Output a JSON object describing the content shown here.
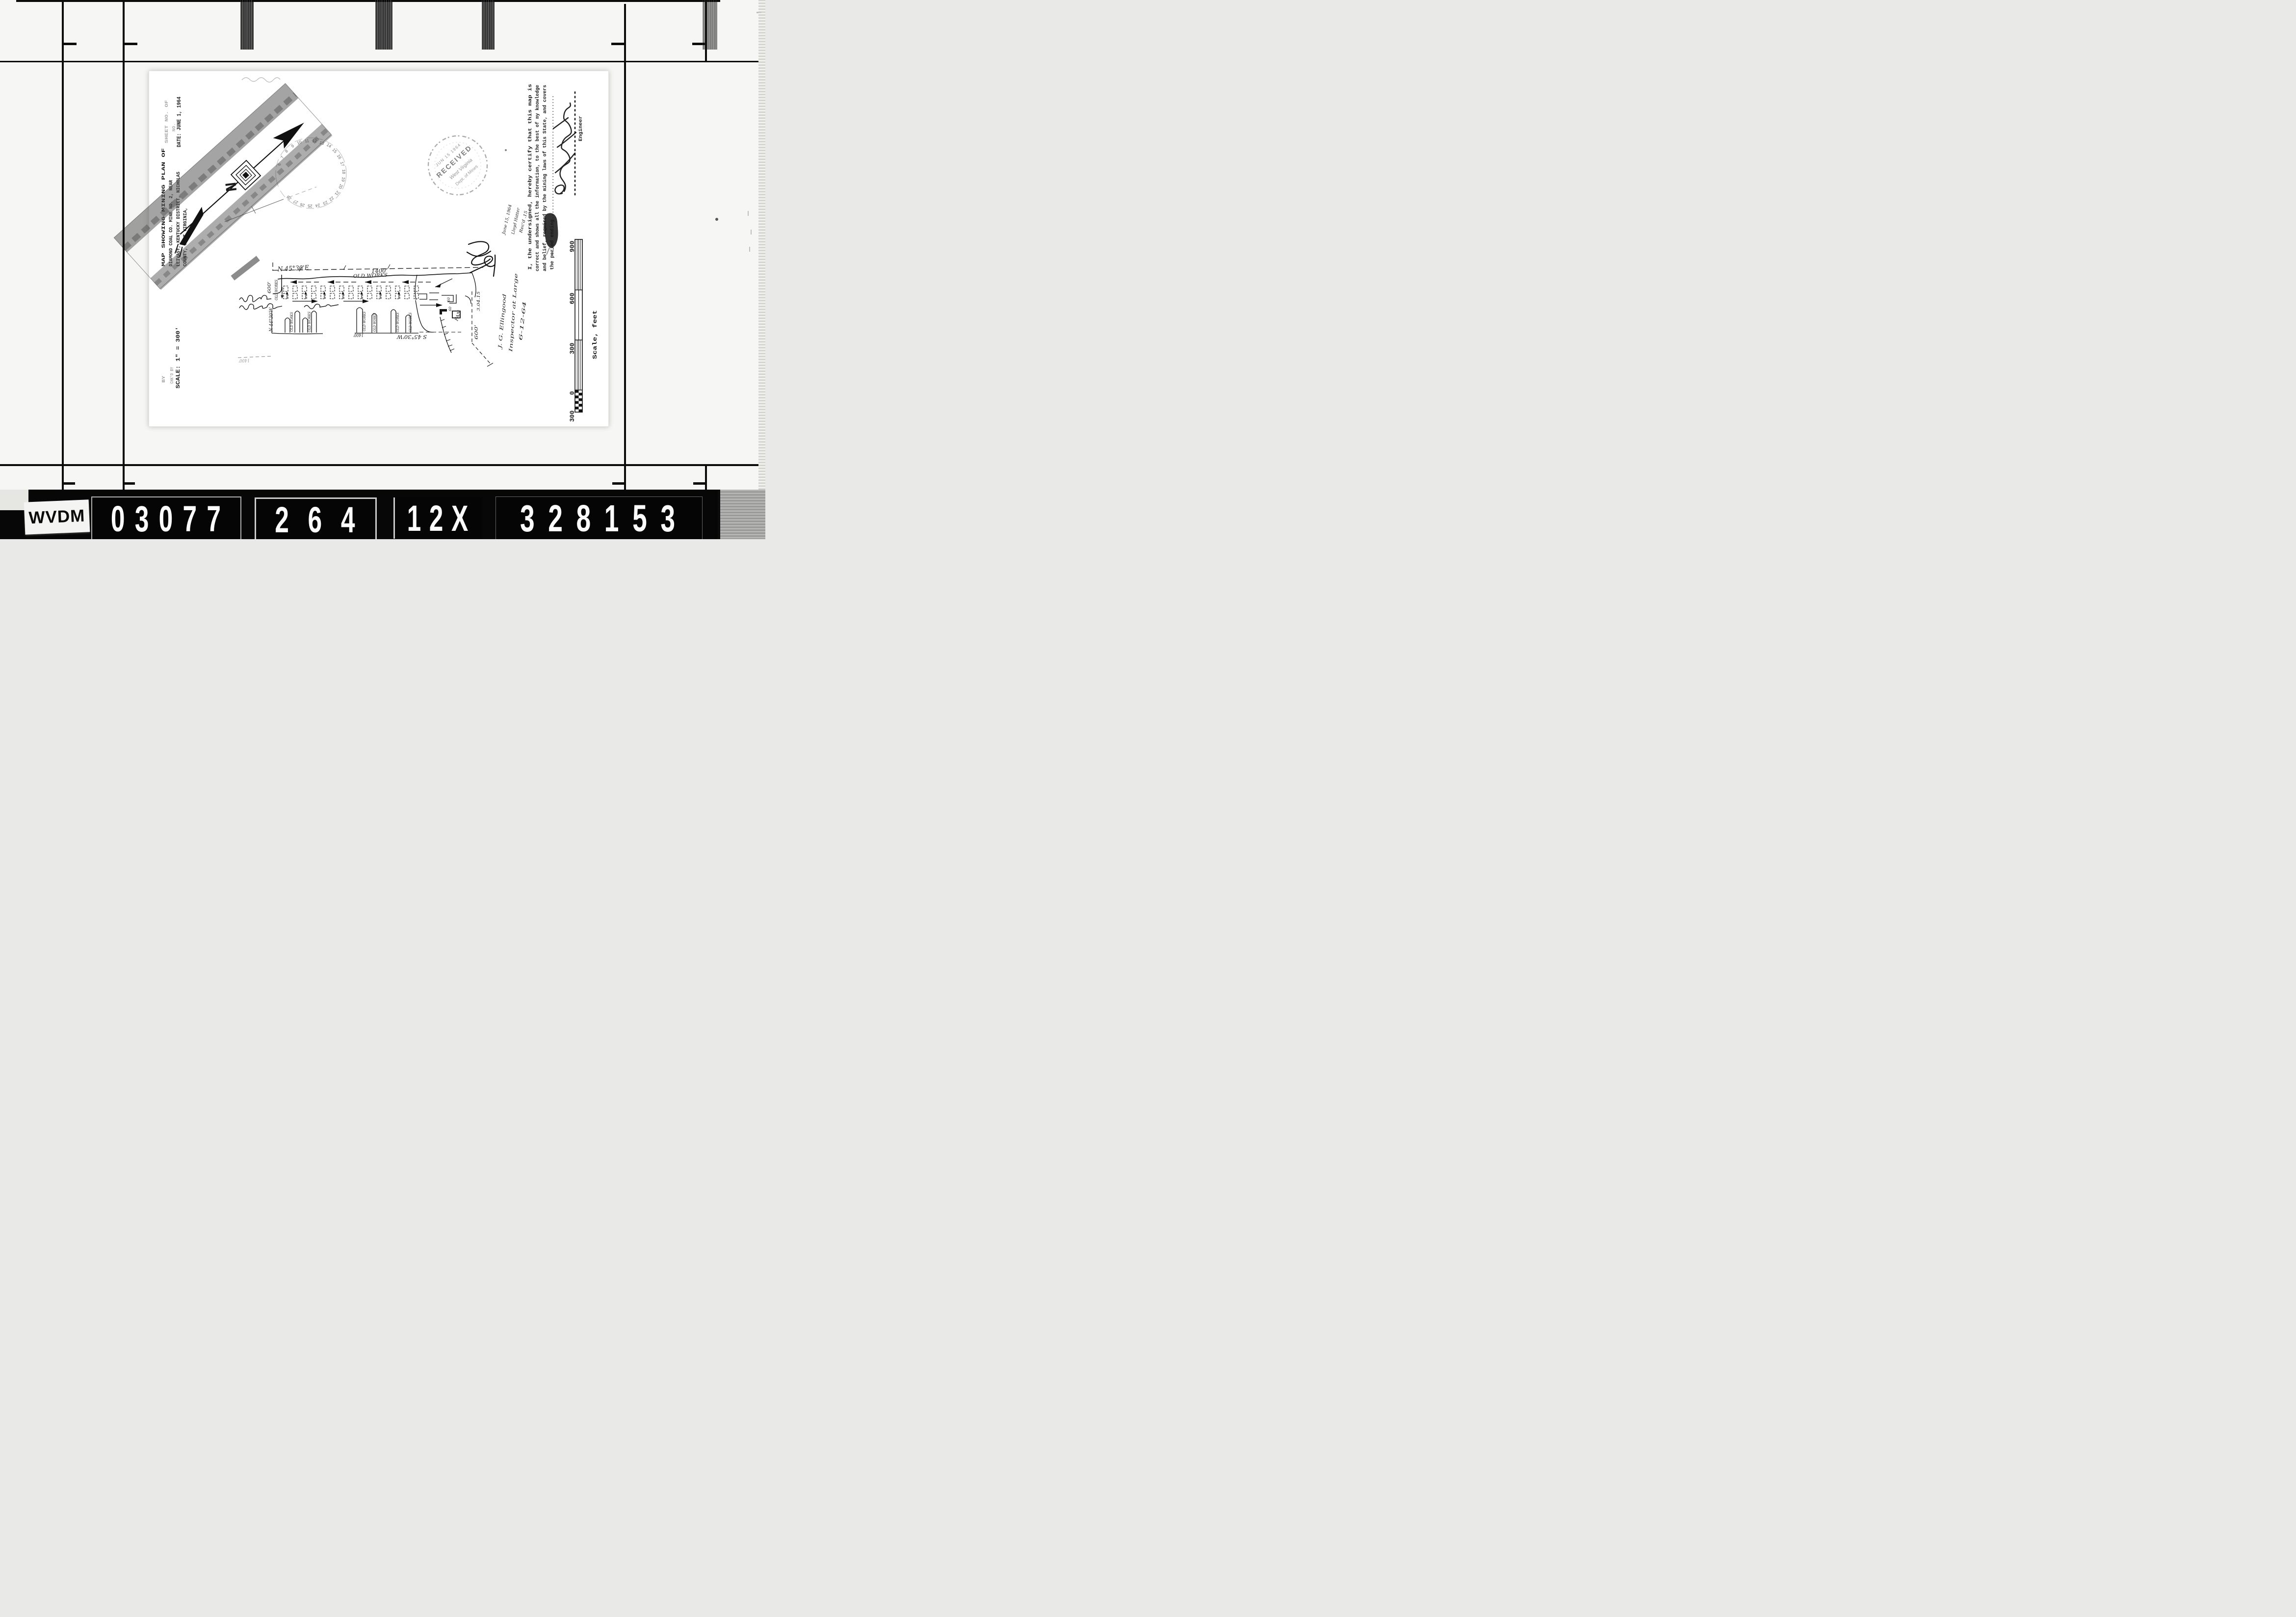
{
  "film": {
    "archive_code": "WVDM",
    "reel_number": "03077",
    "frame_number": "264",
    "reduction_factor": "12X",
    "document_id": "328153"
  },
  "legend": {
    "sheet_line": "SHEET NO.      OF",
    "no_line": "NO.",
    "title_line1": "MAP SHOWING MINING PLAN OF",
    "title_line2": "DIAMOND COAL CO. MINE NO. 2, NEAR",
    "title_line3": "LEIVASY, KENTUCKY DISTRICT, NICHOLAS",
    "title_line4": "COUNTY, WEST VIRGINIA,",
    "date_line": "DATE: JUNE 1, 1964",
    "scale_line": "SCALE: 1\" = 300'",
    "by_line": "BY",
    "checked_line": "CHK'D BY"
  },
  "compass": {
    "north": "N",
    "ring": [
      "6",
      "7",
      "8",
      "9",
      "10",
      "11",
      "12",
      "13",
      "14",
      "15",
      "16",
      "17",
      "18",
      "19",
      "20",
      "21",
      "22",
      "23",
      "24",
      "25",
      "26",
      "27",
      "28"
    ]
  },
  "stamp": {
    "date": "JUN 15 1964",
    "received": "RECEIVED",
    "state": "West Virginia",
    "dept": "Dept. of Mines"
  },
  "map": {
    "bearing_top": "N 45°30'E",
    "bearing_left": "N 44°30'W",
    "bearing_bottom": "S 45°30'W",
    "distance_top": "1400'",
    "distance_bottom": "1400'",
    "distance_bottom_left": "1400'",
    "distance_left": "600'",
    "distance_right": "600'",
    "note_right": "3.04.15",
    "works_top": "OLD WORKS",
    "works_left": "OLD WORKS",
    "works_labels": [
      "OLD WORKS",
      "OLD WORKS",
      "OLD WORKS",
      "OLD WORKS",
      "OLD WORKS",
      "OLD WORKS"
    ],
    "fan": "FAN",
    "entry_width_1": "60",
    "entry_width_2": "60"
  },
  "certification": {
    "line1": "I, the undersigned, hereby certify that this map is",
    "line2": "correct and shows all the information, to the best of my knowledge",
    "line3": "and belief, required by the mining laws of this State, and covers",
    "line4": "the period ending.........................................."
  },
  "signature": {
    "role": "Engineer"
  },
  "notes": {
    "received_1": "June 15, 1964",
    "received_2": "Lloyd Hatter",
    "received_3": "Rec'd .15",
    "inspector_1": "J. G. Ellingood",
    "inspector_2": "Inspector at Large",
    "inspector_3": "6-12-64"
  },
  "scale_bar": {
    "label_300L": "300",
    "label_0": "0",
    "label_300": "300",
    "label_600": "600",
    "label_900": "900",
    "caption": "Scale, feet"
  }
}
